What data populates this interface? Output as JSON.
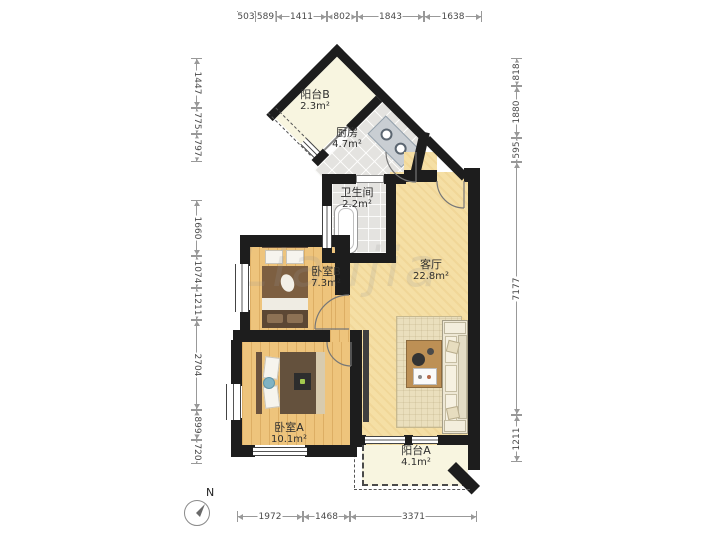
{
  "watermark": "Lianjia",
  "compass": {
    "label": "N"
  },
  "rooms": {
    "balcony_b": {
      "name": "阳台B",
      "area": "2.3m²"
    },
    "kitchen": {
      "name": "厨房",
      "area": "4.7m²"
    },
    "bathroom": {
      "name": "卫生间",
      "area": "2.2m²"
    },
    "bedroom_b": {
      "name": "卧室B",
      "area": "7.3m²"
    },
    "living_room": {
      "name": "客厅",
      "area": "22.8m²"
    },
    "bedroom_a": {
      "name": "卧室A",
      "area": "10.1m²"
    },
    "balcony_a": {
      "name": "阳台A",
      "area": "4.1m²"
    }
  },
  "dimensions": {
    "top": [
      "503",
      "589",
      "1411",
      "802",
      "1843",
      "1638"
    ],
    "left": [
      "1447",
      "775",
      "797",
      "1660",
      "1074",
      "1211",
      "2704",
      "899",
      "720"
    ],
    "right": [
      "818",
      "1880",
      "595",
      "7177",
      "1211"
    ],
    "bottom": [
      "1972",
      "1468",
      "3371"
    ]
  },
  "colors": {
    "wall": "#1d1d1d",
    "living_floor": "#f5dfa5",
    "wood_floor": "#eec47c",
    "tile_floor": "#e4e3e0",
    "balcony_floor": "#f8f5e0",
    "dimension_line": "#999999"
  }
}
